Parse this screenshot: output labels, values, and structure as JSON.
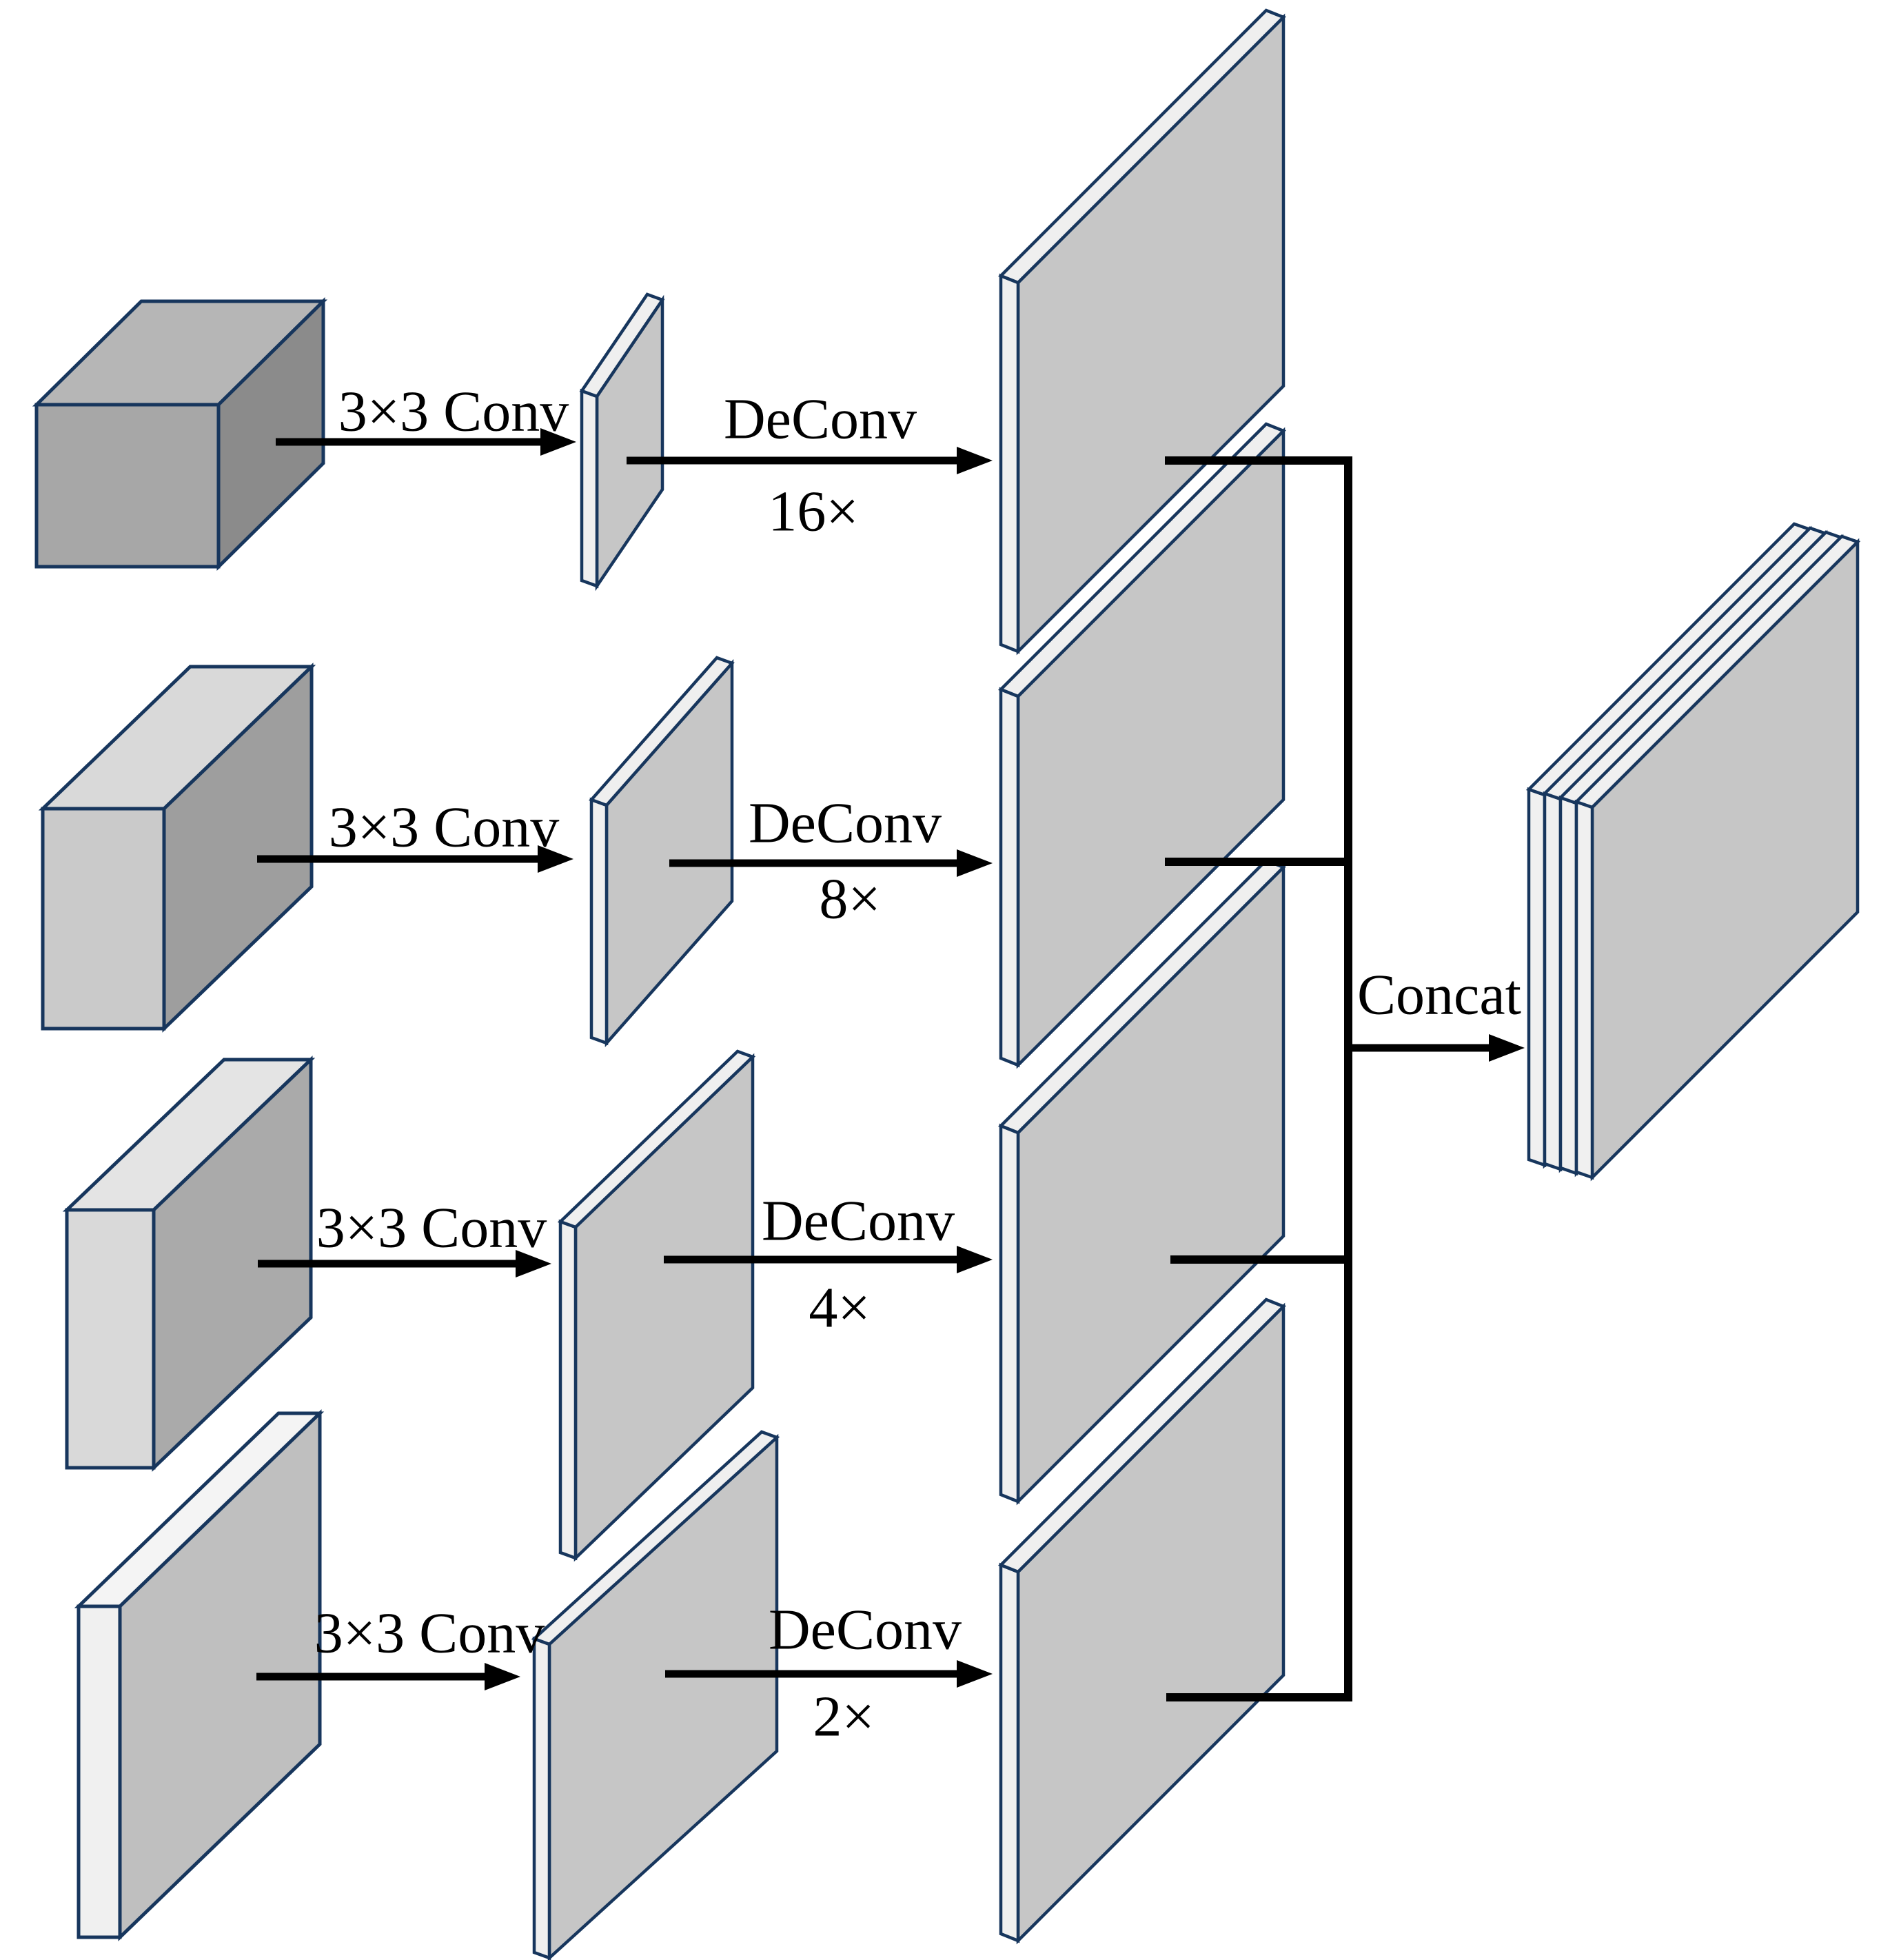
{
  "diagram": {
    "rows": [
      {
        "conv_label": "3×3 Conv",
        "deconv_label": "DeConv",
        "scale_label": "16×"
      },
      {
        "conv_label": "3×3 Conv",
        "deconv_label": "DeConv",
        "scale_label": "8×"
      },
      {
        "conv_label": "3×3 Conv",
        "deconv_label": "DeConv",
        "scale_label": "4×"
      },
      {
        "conv_label": "3×3 Conv",
        "deconv_label": "DeConv",
        "scale_label": "2×"
      }
    ],
    "concat_label": "Concat"
  },
  "colors": {
    "outline": "#17365d",
    "arrow": "#000000",
    "plate_face": "#c6c6c6",
    "plate_edge": "#efefef",
    "output_face": "#c6c6c6",
    "output_edge": "#f0f0f0",
    "box1_front": "#a7a7a7",
    "box1_top": "#b6b6b6",
    "box1_side": "#8b8b8b",
    "box2_front": "#cacaca",
    "box2_top": "#d9d9d9",
    "box2_side": "#9e9e9e",
    "box3_front": "#d9d9d9",
    "box3_top": "#e4e4e4",
    "box3_side": "#aaaaaa",
    "box4_front": "#f0f0f0",
    "box4_top": "#f4f4f4",
    "box4_side": "#bfbfbf"
  }
}
